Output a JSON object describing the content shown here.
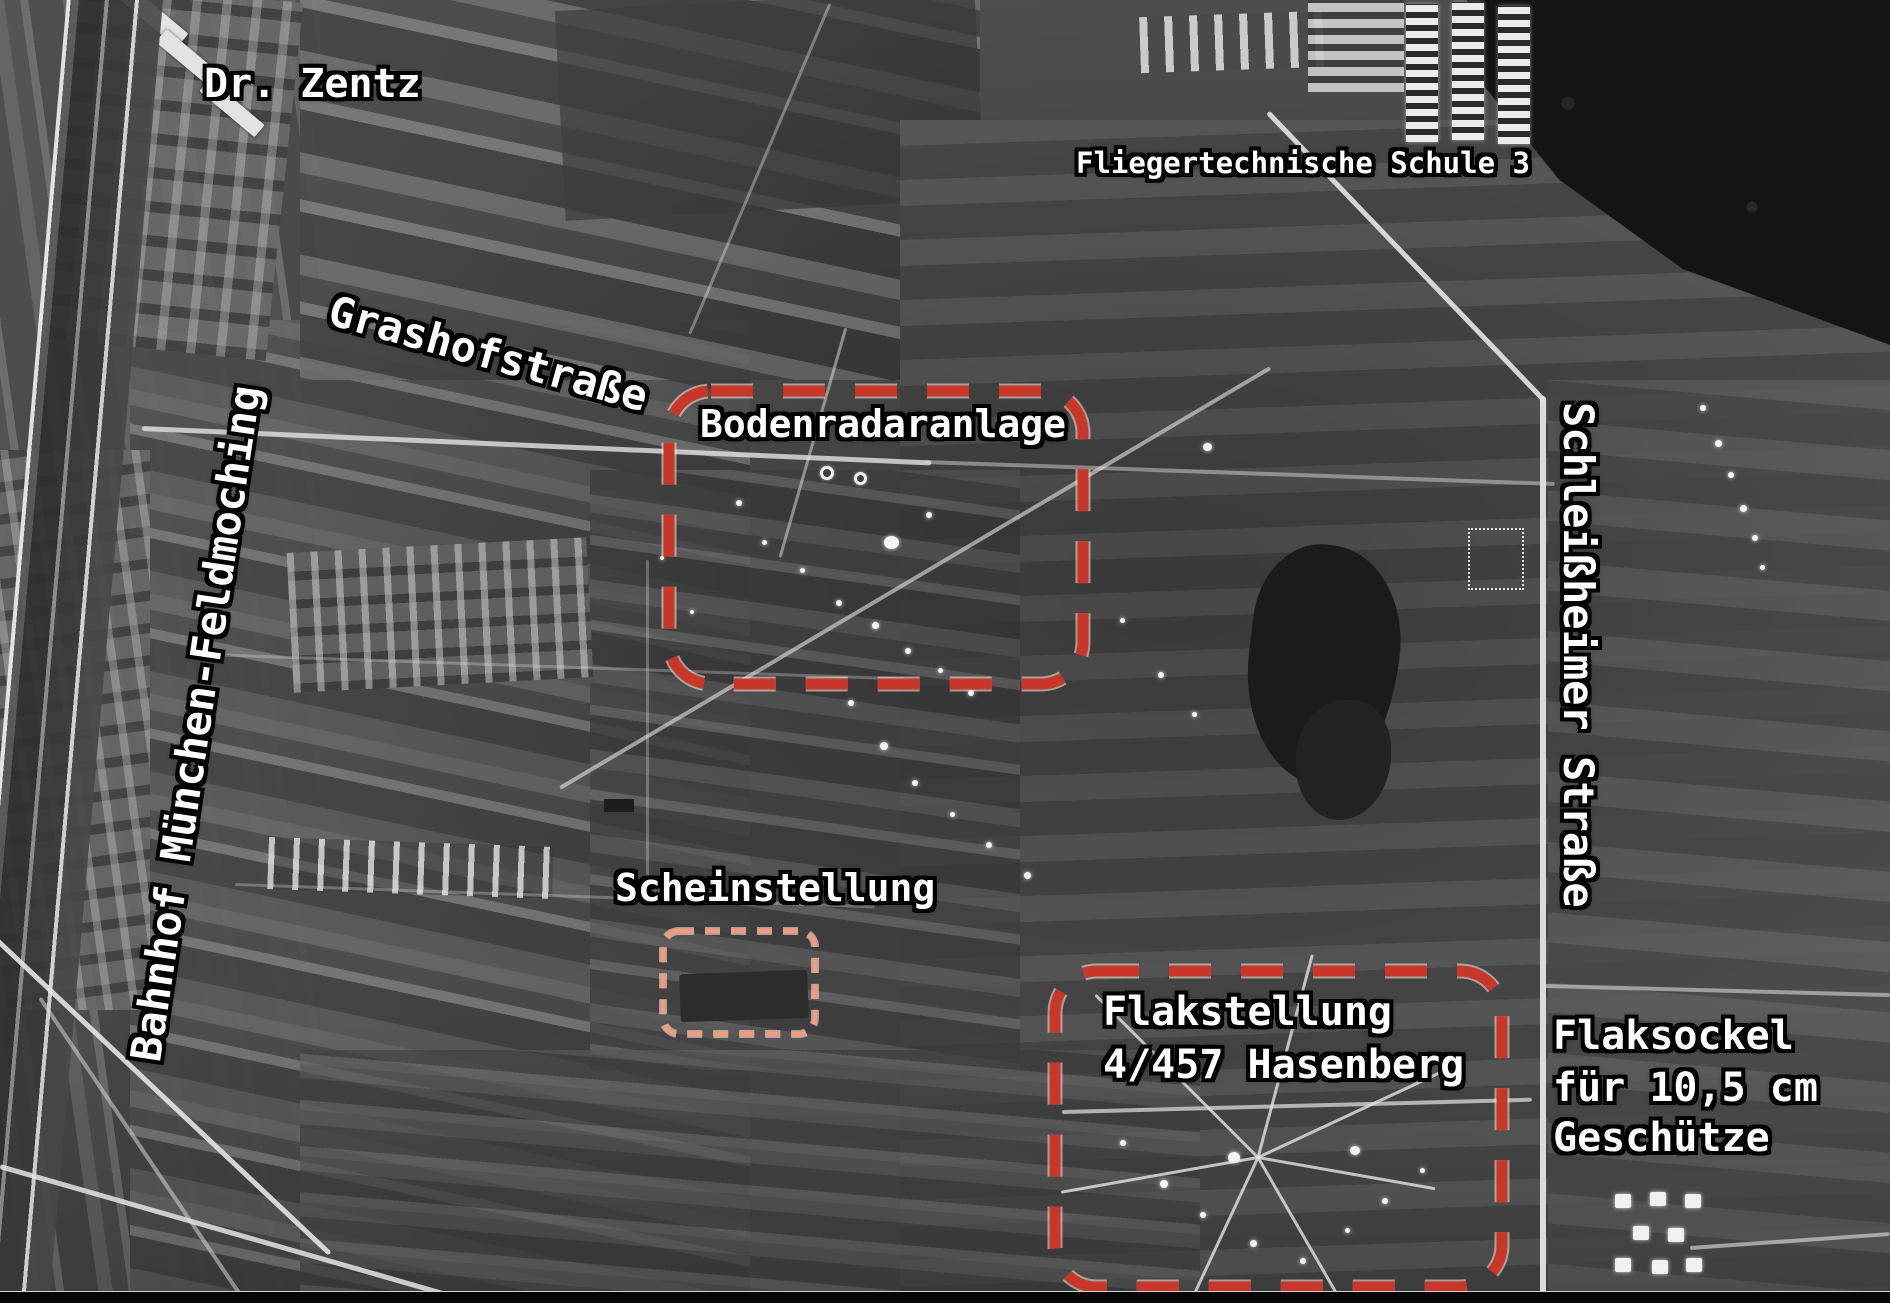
{
  "annotations": {
    "dr_zentz": "Dr. Zentz",
    "fliegertechnische_schule": "Fliegertechnische Schule 3",
    "grashofstrasse": "Grashofstraße",
    "bahnhof": "Bahnhof München-Feldmoching",
    "bodenradaranlage": "Bodenradaranlage",
    "schleissheimer_strasse": "Schleißheimer Straße",
    "scheinstellung": "Scheinstellung",
    "flakstellung_line1": "Flakstellung",
    "flakstellung_line2": "4/457 Hasenberg",
    "flaksockel_line1": "Flaksockel",
    "flaksockel_line2": "für 10,5 cm",
    "flaksockel_line3": "Geschütze"
  },
  "colors": {
    "marker_red": "#c8372a",
    "marker_salmon": "#f09c83",
    "label_text": "#ffffff",
    "label_outline": "#000000"
  }
}
